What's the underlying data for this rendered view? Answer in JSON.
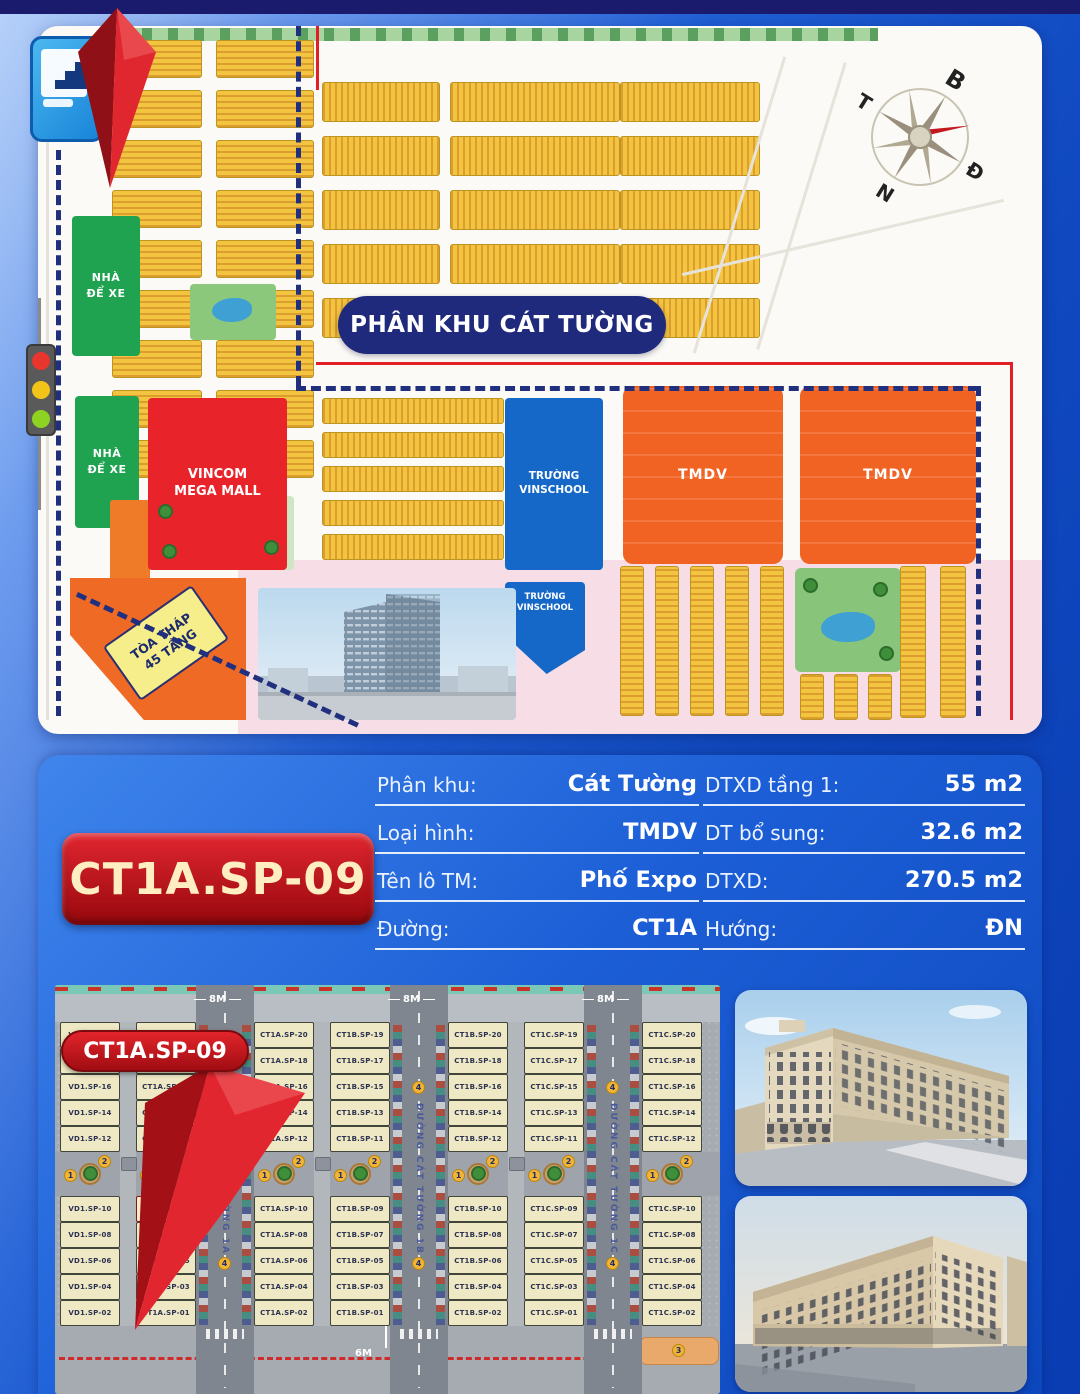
{
  "masterplan": {
    "banner": "PHÂN KHU CÁT TƯỜNG",
    "compass": {
      "north": "B",
      "east": "Đ",
      "south": "N",
      "west": "T"
    },
    "zones": {
      "parking1": "NHÀ ĐỂ XE",
      "parking2": "NHÀ ĐỂ XE",
      "mall": "VINCOM MEGA MALL",
      "school1": "TRƯỜNG VINSCHOOL",
      "school2": "TRƯỜNG VINSCHOOL",
      "tmdv1": "TMDV",
      "tmdv2": "TMDV",
      "tower": "TÒA THÁP 45 TẦNG"
    }
  },
  "info": {
    "badge": "CT1A.SP-09",
    "left": [
      {
        "label": "Phân khu:",
        "value": "Cát Tường"
      },
      {
        "label": "Loại hình:",
        "value": "TMDV"
      },
      {
        "label": "Tên lô TM:",
        "value": "Phố Expo"
      },
      {
        "label": "Đường:",
        "value": "CT1A"
      }
    ],
    "right": [
      {
        "label": "DTXD tầng 1:",
        "value": "55 m2"
      },
      {
        "label": "DT bổ sung:",
        "value": "32.6 m2"
      },
      {
        "label": "DTXD:",
        "value": "270.5 m2"
      },
      {
        "label": "Hướng:",
        "value": "ĐN"
      }
    ]
  },
  "siteplan": {
    "badge": "CT1A.SP-09",
    "highlight": "CT1A.SP-09",
    "road_width_top": "8M",
    "road_width_bottom": "6M",
    "streets": [
      "ĐƯỜNG CÁT TƯỜNG 1A",
      "ĐƯỜNG CÁT TƯỜNG 1B",
      "ĐƯỜNG CÁT TƯỜNG 1C"
    ],
    "markers": {
      "pair": [
        "1",
        "2"
      ],
      "street": "4",
      "strip": "3"
    },
    "columns": [
      {
        "lots": [
          "VD1.SP-20",
          "VD1.SP-18",
          "VD1.SP-16",
          "VD1.SP-14",
          "VD1.SP-12",
          "VD1.SP-10",
          "VD1.SP-08",
          "VD1.SP-06",
          "VD1.SP-04",
          "VD1.SP-02"
        ]
      },
      {
        "lots": [
          "CT1A.SP-19",
          "CT1A.SP-17",
          "CT1A.SP-15",
          "CT1A.SP-13",
          "CT1A.SP-11",
          "CT1A.SP-09",
          "CT1A.SP-07",
          "CT1A.SP-05",
          "CT1A.SP-03",
          "CT1A.SP-01"
        ]
      },
      {
        "lots": [
          "CT1A.SP-20",
          "CT1A.SP-18",
          "CT1A.SP-16",
          "CT1A.SP-14",
          "CT1A.SP-12",
          "CT1A.SP-10",
          "CT1A.SP-08",
          "CT1A.SP-06",
          "CT1A.SP-04",
          "CT1A.SP-02"
        ]
      },
      {
        "lots": [
          "CT1B.SP-19",
          "CT1B.SP-17",
          "CT1B.SP-15",
          "CT1B.SP-13",
          "CT1B.SP-11",
          "CT1B.SP-09",
          "CT1B.SP-07",
          "CT1B.SP-05",
          "CT1B.SP-03",
          "CT1B.SP-01"
        ]
      },
      {
        "lots": [
          "CT1B.SP-20",
          "CT1B.SP-18",
          "CT1B.SP-16",
          "CT1B.SP-14",
          "CT1B.SP-12",
          "CT1B.SP-10",
          "CT1B.SP-08",
          "CT1B.SP-06",
          "CT1B.SP-04",
          "CT1B.SP-02"
        ]
      },
      {
        "lots": [
          "CT1C.SP-19",
          "CT1C.SP-17",
          "CT1C.SP-15",
          "CT1C.SP-13",
          "CT1C.SP-11",
          "CT1C.SP-09",
          "CT1C.SP-07",
          "CT1C.SP-05",
          "CT1C.SP-03",
          "CT1C.SP-01"
        ]
      },
      {
        "lots": [
          "CT1C.SP-20",
          "CT1C.SP-18",
          "CT1C.SP-16",
          "CT1C.SP-14",
          "CT1C.SP-12",
          "CT1C.SP-10",
          "CT1C.SP-08",
          "CT1C.SP-06",
          "CT1C.SP-04",
          "CT1C.SP-02"
        ]
      }
    ]
  },
  "colors": {
    "accent_red": "#d9252b",
    "panel_blue": "#1a5ed2",
    "navy": "#202a7c",
    "tmdv_orange": "#f16322",
    "school_blue": "#1568c8",
    "parking_green": "#1fa351",
    "mall_red": "#e8232a",
    "lot_cream": "#efe8c4",
    "housing_yellow": "#f2c440"
  }
}
